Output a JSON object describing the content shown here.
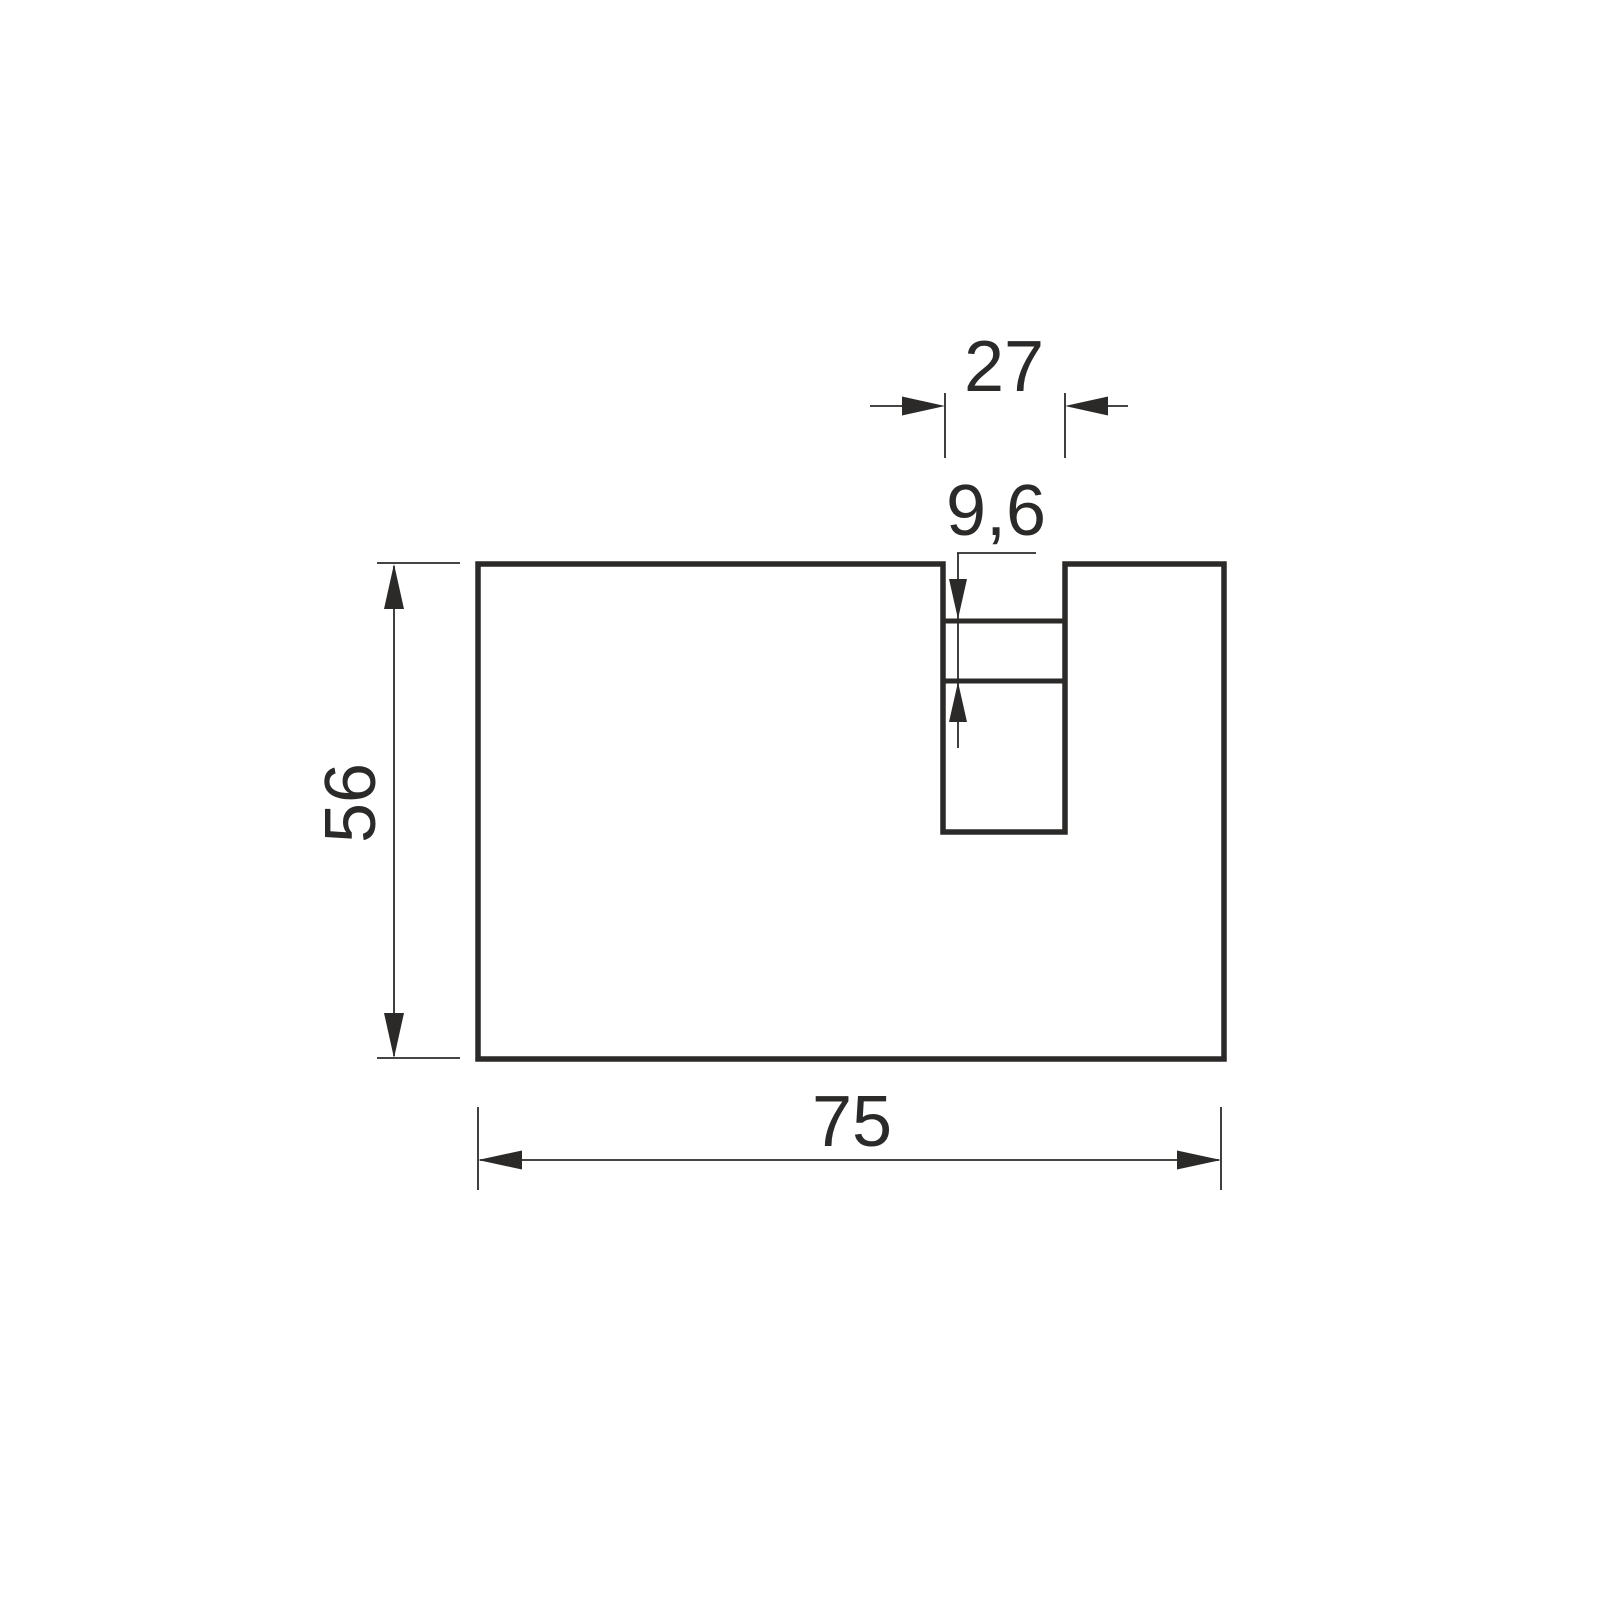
{
  "diagram": {
    "kind": "technical-drawing",
    "labels": {
      "slot_width": "27",
      "slot_step": "9,6",
      "outer_height": "56",
      "outer_width": "75"
    },
    "colors": {
      "line": "#2b2a29",
      "background": "#ffffff"
    }
  }
}
